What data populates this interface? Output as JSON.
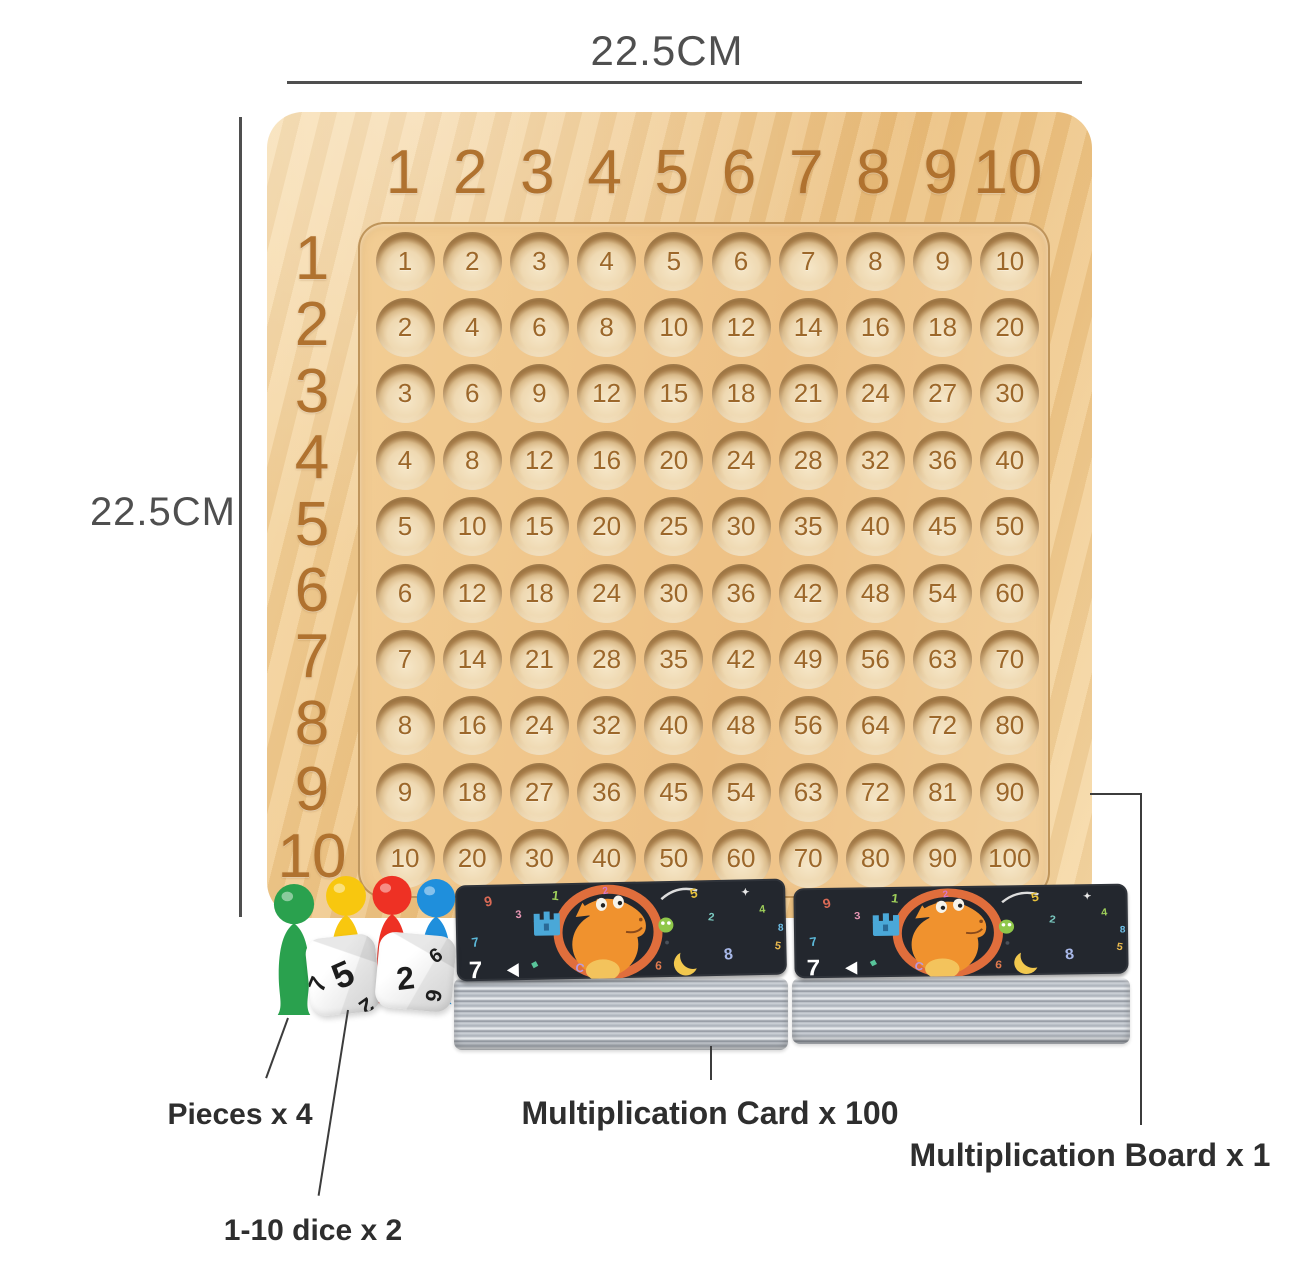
{
  "dimensions": {
    "width_label": "22.5CM",
    "height_label": "22.5CM"
  },
  "board": {
    "column_headers": [
      "1",
      "2",
      "3",
      "4",
      "5",
      "6",
      "7",
      "8",
      "9",
      "10"
    ],
    "row_headers": [
      "1",
      "2",
      "3",
      "4",
      "5",
      "6",
      "7",
      "8",
      "9",
      "10"
    ],
    "products": [
      [
        1,
        2,
        3,
        4,
        5,
        6,
        7,
        8,
        9,
        10
      ],
      [
        2,
        4,
        6,
        8,
        10,
        12,
        14,
        16,
        18,
        20
      ],
      [
        3,
        6,
        9,
        12,
        15,
        18,
        21,
        24,
        27,
        30
      ],
      [
        4,
        8,
        12,
        16,
        20,
        24,
        28,
        32,
        36,
        40
      ],
      [
        5,
        10,
        15,
        20,
        25,
        30,
        35,
        40,
        45,
        50
      ],
      [
        6,
        12,
        18,
        24,
        30,
        36,
        42,
        48,
        54,
        60
      ],
      [
        7,
        14,
        21,
        28,
        35,
        42,
        49,
        56,
        63,
        70
      ],
      [
        8,
        16,
        24,
        32,
        40,
        48,
        56,
        64,
        72,
        80
      ],
      [
        9,
        18,
        27,
        36,
        45,
        54,
        63,
        72,
        81,
        90
      ],
      [
        10,
        20,
        30,
        40,
        50,
        60,
        70,
        80,
        90,
        100
      ]
    ]
  },
  "callouts": {
    "pieces": {
      "label": "Pieces x 4"
    },
    "dice": {
      "label": "1-10 dice x 2"
    },
    "cards": {
      "label": "Multiplication Card x 100"
    },
    "board": {
      "label": "Multiplication Board x 1"
    }
  },
  "pawns": [
    {
      "name": "green-pawn",
      "color": "#2aa14e"
    },
    {
      "name": "yellow-pawn",
      "color": "#f8c70f"
    },
    {
      "name": "red-pawn",
      "color": "#ee3124"
    },
    {
      "name": "blue-pawn",
      "color": "#1f8fdc"
    }
  ],
  "dice": {
    "items": [
      {
        "digits": [
          "5",
          "7",
          "2"
        ]
      },
      {
        "digits": [
          "2",
          "9",
          "6"
        ]
      }
    ]
  },
  "cards": {
    "corner_number": "7",
    "confetti": [
      {
        "ch": "9",
        "c": "#d96a56",
        "x": 30,
        "y": 22,
        "s": 14,
        "r": -12
      },
      {
        "ch": "1",
        "c": "#9fd05a",
        "x": 96,
        "y": 16,
        "s": 13,
        "r": 8
      },
      {
        "ch": "3",
        "c": "#e896b4",
        "x": 60,
        "y": 34,
        "s": 11,
        "r": -4
      },
      {
        "ch": "7",
        "c": "#5bb8d8",
        "x": 16,
        "y": 62,
        "s": 13,
        "r": -8
      },
      {
        "ch": "C",
        "c": "#b89ae0",
        "x": 118,
        "y": 88,
        "s": 12,
        "r": 12
      },
      {
        "ch": "5",
        "c": "#e8c23c",
        "x": 236,
        "y": 18,
        "s": 13,
        "r": -14
      },
      {
        "ch": "2",
        "c": "#7ac9c0",
        "x": 252,
        "y": 40,
        "s": 11,
        "r": 8
      },
      {
        "ch": "8",
        "c": "#a8b8e8",
        "x": 268,
        "y": 80,
        "s": 16,
        "r": -6
      },
      {
        "ch": "6",
        "c": "#e07a4e",
        "x": 198,
        "y": 88,
        "s": 12,
        "r": 6
      },
      {
        "ch": "4",
        "c": "#9fd05a",
        "x": 304,
        "y": 34,
        "s": 11,
        "r": -6
      },
      {
        "ch": "✦",
        "c": "#e8e8e8",
        "x": 286,
        "y": 16,
        "s": 10,
        "r": 0
      },
      {
        "ch": "●",
        "c": "#49505a",
        "x": 208,
        "y": 64,
        "s": 9,
        "r": 0
      },
      {
        "ch": "◆",
        "c": "#58c49a",
        "x": 74,
        "y": 82,
        "s": 9,
        "r": 18
      },
      {
        "ch": "5",
        "c": "#e8b84e",
        "x": 318,
        "y": 70,
        "s": 11,
        "r": 10
      },
      {
        "ch": "2",
        "c": "#d878c8",
        "x": 148,
        "y": 12,
        "s": 10,
        "r": -10
      },
      {
        "ch": "8",
        "c": "#6fc0e8",
        "x": 322,
        "y": 52,
        "s": 10,
        "r": 0
      }
    ]
  },
  "colors": {
    "wood_light": "#f6d9a8",
    "wood_mid": "#efc78a",
    "wood_deep": "#e9ba76",
    "engrave": "#b0722f",
    "cell_face": "#efd9b2",
    "cell_rim": "#c19660",
    "cell_num": "#9c672a",
    "dim": "#4f4f4f",
    "line": "#3c3c3c",
    "label": "#2e2e2e",
    "card_face": "#23272e",
    "ring": "#e06e3c",
    "dino": "#f0922e",
    "die_num": "#1d1d1d"
  }
}
